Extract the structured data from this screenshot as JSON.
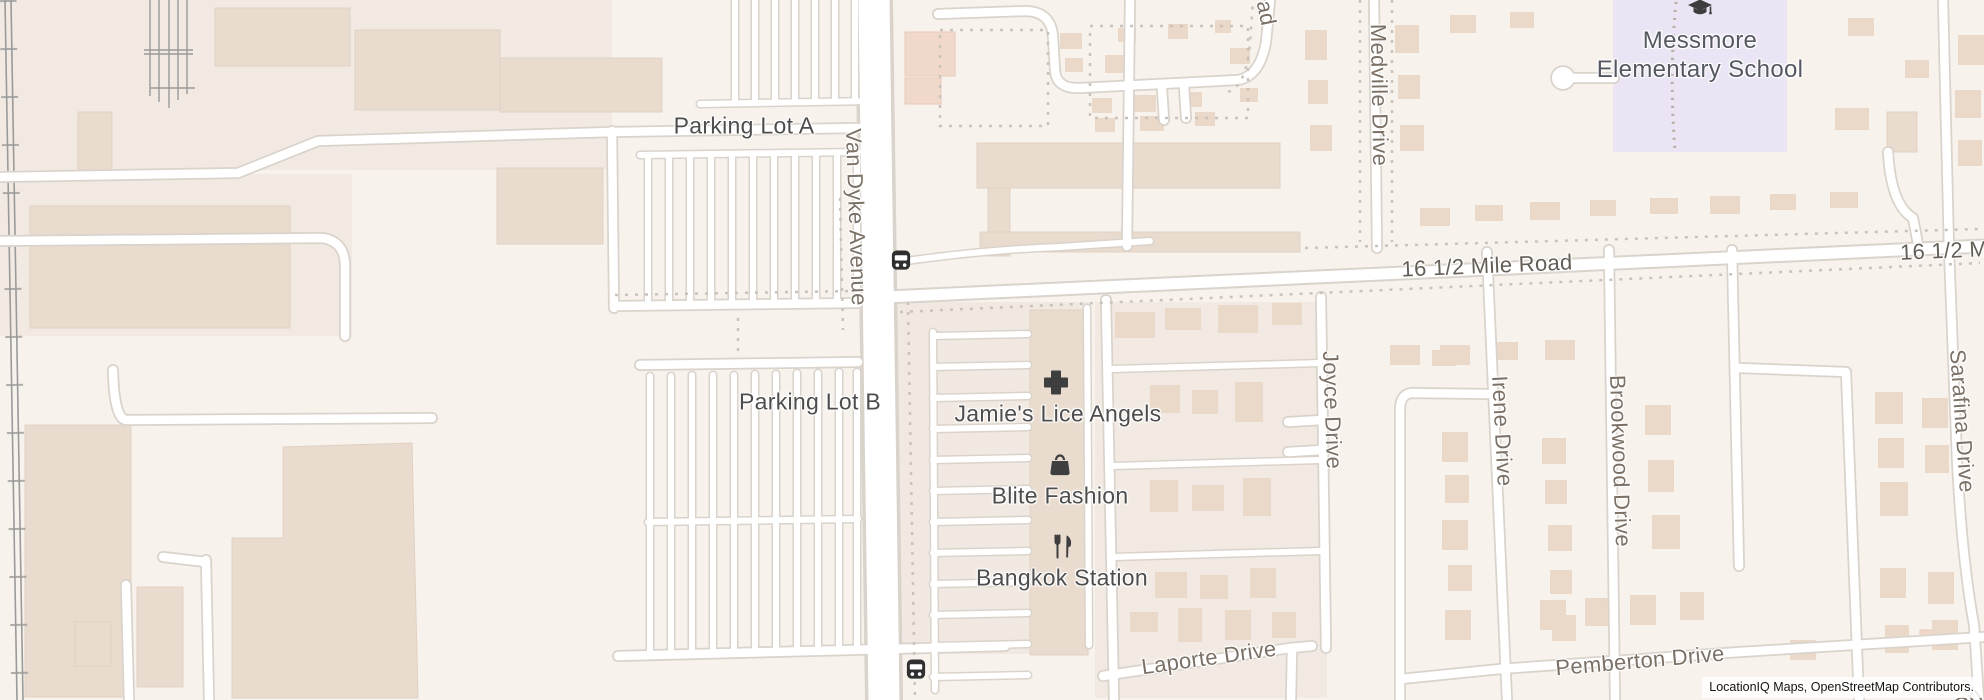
{
  "map": {
    "attribution": "LocationIQ Maps, OpenStreetMap Contributors.",
    "labels": {
      "parking_lot_a": "Parking Lot A",
      "parking_lot_b": "Parking Lot B",
      "van_dyke_avenue": "Van Dyke Avenue",
      "mile_road": "16 1/2 Mile Road",
      "mile_road_partial": "16 1/2 M",
      "road_partial_top": "ad",
      "road_partial_bottom": "Dri",
      "medville_drive": "Medville Drive",
      "joyce_drive": "Joyce Drive",
      "irene_drive": "Irene Drive",
      "brookwood_drive": "Brookwood Drive",
      "sarafina_drive": "Sarafina Drive",
      "laporte_drive": "Laporte Drive",
      "pemberton_drive": "Pemberton Drive",
      "school_name_line1": "Messmore",
      "school_name_line2": "Elementary School"
    },
    "pois": [
      {
        "name": "Jamie's Lice Angels",
        "icon": "medical-cross-icon"
      },
      {
        "name": "Blite Fashion",
        "icon": "shopping-bag-icon"
      },
      {
        "name": "Bangkok Station",
        "icon": "restaurant-icon"
      }
    ],
    "icons": {
      "school": "graduation-cap-icon",
      "bus_stop": "bus-stop-icon"
    },
    "colors": {
      "background": "#f7f2ec",
      "parcel": "#f2eae2",
      "building": "#e9dbce",
      "house": "#ead9c9",
      "school_area": "#eae4f4",
      "road_fill": "#ffffff",
      "road_casing": "#d9d3cb",
      "railway": "#9a9a9a",
      "street_label": "#7b7065",
      "poi_label": "#4d4d4d"
    }
  }
}
